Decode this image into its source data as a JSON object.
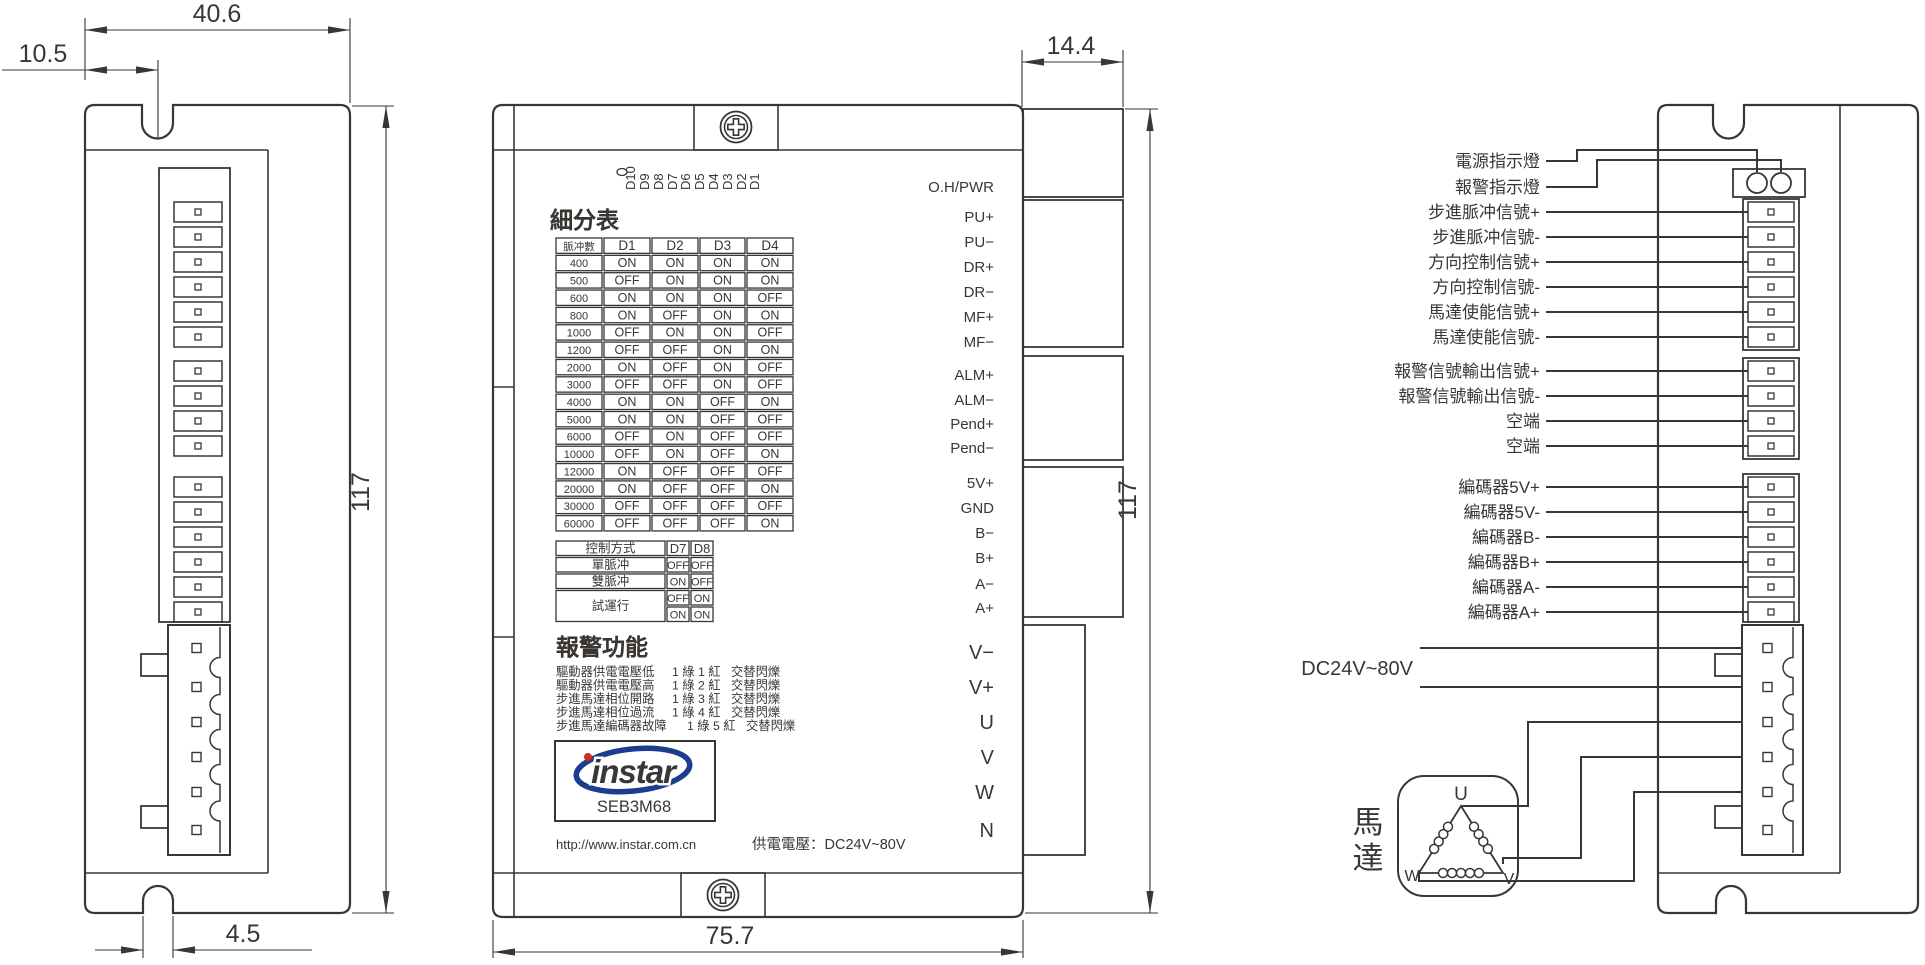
{
  "drawing": {
    "bg": "#ffffff",
    "line_color": "#3a3633",
    "logo_blue": "#1b3c8f",
    "logo_red": "#d22b1f"
  },
  "dimensions": {
    "width_top": "40.6",
    "notch_offset": "10.5",
    "height_side": "117",
    "slot_width": "4.5",
    "connector_depth": "14.4",
    "height_front": "117",
    "width_front": "75.7"
  },
  "front_panel": {
    "dip_labels": [
      "D10",
      "D9",
      "D8",
      "D7",
      "D6",
      "D5",
      "D4",
      "D3",
      "D2",
      "D1"
    ],
    "microstep_table": {
      "title": "細分表",
      "headers": [
        "脈冲數",
        "D1",
        "D2",
        "D3",
        "D4"
      ],
      "rows": [
        [
          "400",
          "ON",
          "ON",
          "ON",
          "ON"
        ],
        [
          "500",
          "OFF",
          "ON",
          "ON",
          "ON"
        ],
        [
          "600",
          "ON",
          "ON",
          "ON",
          "OFF"
        ],
        [
          "800",
          "ON",
          "OFF",
          "ON",
          "ON"
        ],
        [
          "1000",
          "OFF",
          "ON",
          "ON",
          "OFF"
        ],
        [
          "1200",
          "OFF",
          "OFF",
          "ON",
          "ON"
        ],
        [
          "2000",
          "ON",
          "OFF",
          "ON",
          "OFF"
        ],
        [
          "3000",
          "OFF",
          "OFF",
          "ON",
          "OFF"
        ],
        [
          "4000",
          "ON",
          "ON",
          "OFF",
          "ON"
        ],
        [
          "5000",
          "ON",
          "ON",
          "OFF",
          "OFF"
        ],
        [
          "6000",
          "OFF",
          "ON",
          "OFF",
          "OFF"
        ],
        [
          "10000",
          "OFF",
          "ON",
          "OFF",
          "ON"
        ],
        [
          "12000",
          "ON",
          "OFF",
          "OFF",
          "OFF"
        ],
        [
          "20000",
          "ON",
          "OFF",
          "OFF",
          "ON"
        ],
        [
          "30000",
          "OFF",
          "OFF",
          "OFF",
          "OFF"
        ],
        [
          "60000",
          "OFF",
          "OFF",
          "OFF",
          "ON"
        ]
      ]
    },
    "control_table": {
      "headers": [
        "控制方式",
        "D7",
        "D8"
      ],
      "rows": [
        {
          "label": "單脈冲",
          "values": [
            [
              "OFF",
              "OFF"
            ]
          ]
        },
        {
          "label": "雙脈冲",
          "values": [
            [
              "ON",
              "OFF"
            ]
          ]
        },
        {
          "label": "試運行",
          "values": [
            [
              "OFF",
              "ON"
            ],
            [
              "ON",
              "ON"
            ]
          ]
        }
      ]
    },
    "alarm": {
      "title": "報警功能",
      "rows": [
        {
          "cause": "驅動器供電電壓低",
          "code": "1 綠 1 紅",
          "mode": "交替閃爍"
        },
        {
          "cause": "驅動器供電電壓高",
          "code": "1 綠 2 紅",
          "mode": "交替閃爍"
        },
        {
          "cause": "步進馬達相位開路",
          "code": "1 綠 3 紅",
          "mode": "交替閃爍"
        },
        {
          "cause": "步進馬達相位過流",
          "code": "1 綠 4 紅",
          "mode": "交替閃爍"
        },
        {
          "cause": "步進馬達編碼器故障",
          "code": "1 綠 5 紅",
          "mode": "交替閃爍"
        }
      ]
    },
    "terminals": [
      "O.H/PWR",
      "PU+",
      "PU−",
      "DR+",
      "DR−",
      "MF+",
      "MF−",
      "ALM+",
      "ALM−",
      "Pend+",
      "Pend−",
      "5V+",
      "GND",
      "B−",
      "B+",
      "A−",
      "A+",
      "V−",
      "V+",
      "U",
      "V",
      "W",
      "N"
    ],
    "logo": {
      "brand": "instar",
      "model": "SEB3M68",
      "url": "http://www.instar.com.cn"
    },
    "power_note": "供電電壓：DC24V~80V"
  },
  "wiring": {
    "labels": [
      "電源指示燈",
      "報警指示燈",
      "步進脈冲信號+",
      "步進脈冲信號-",
      "方向控制信號+",
      "方向控制信號-",
      "馬達使能信號+",
      "馬達使能信號-",
      "報警信號輸出信號+",
      "報警信號輸出信號-",
      "空端",
      "空端",
      "編碼器5V+",
      "編碼器5V-",
      "編碼器B-",
      "編碼器B+",
      "編碼器A-",
      "編碼器A+"
    ],
    "power_label": "DC24V~80V",
    "motor_label": "馬達",
    "motor_pins": [
      "U",
      "V",
      "W"
    ]
  }
}
